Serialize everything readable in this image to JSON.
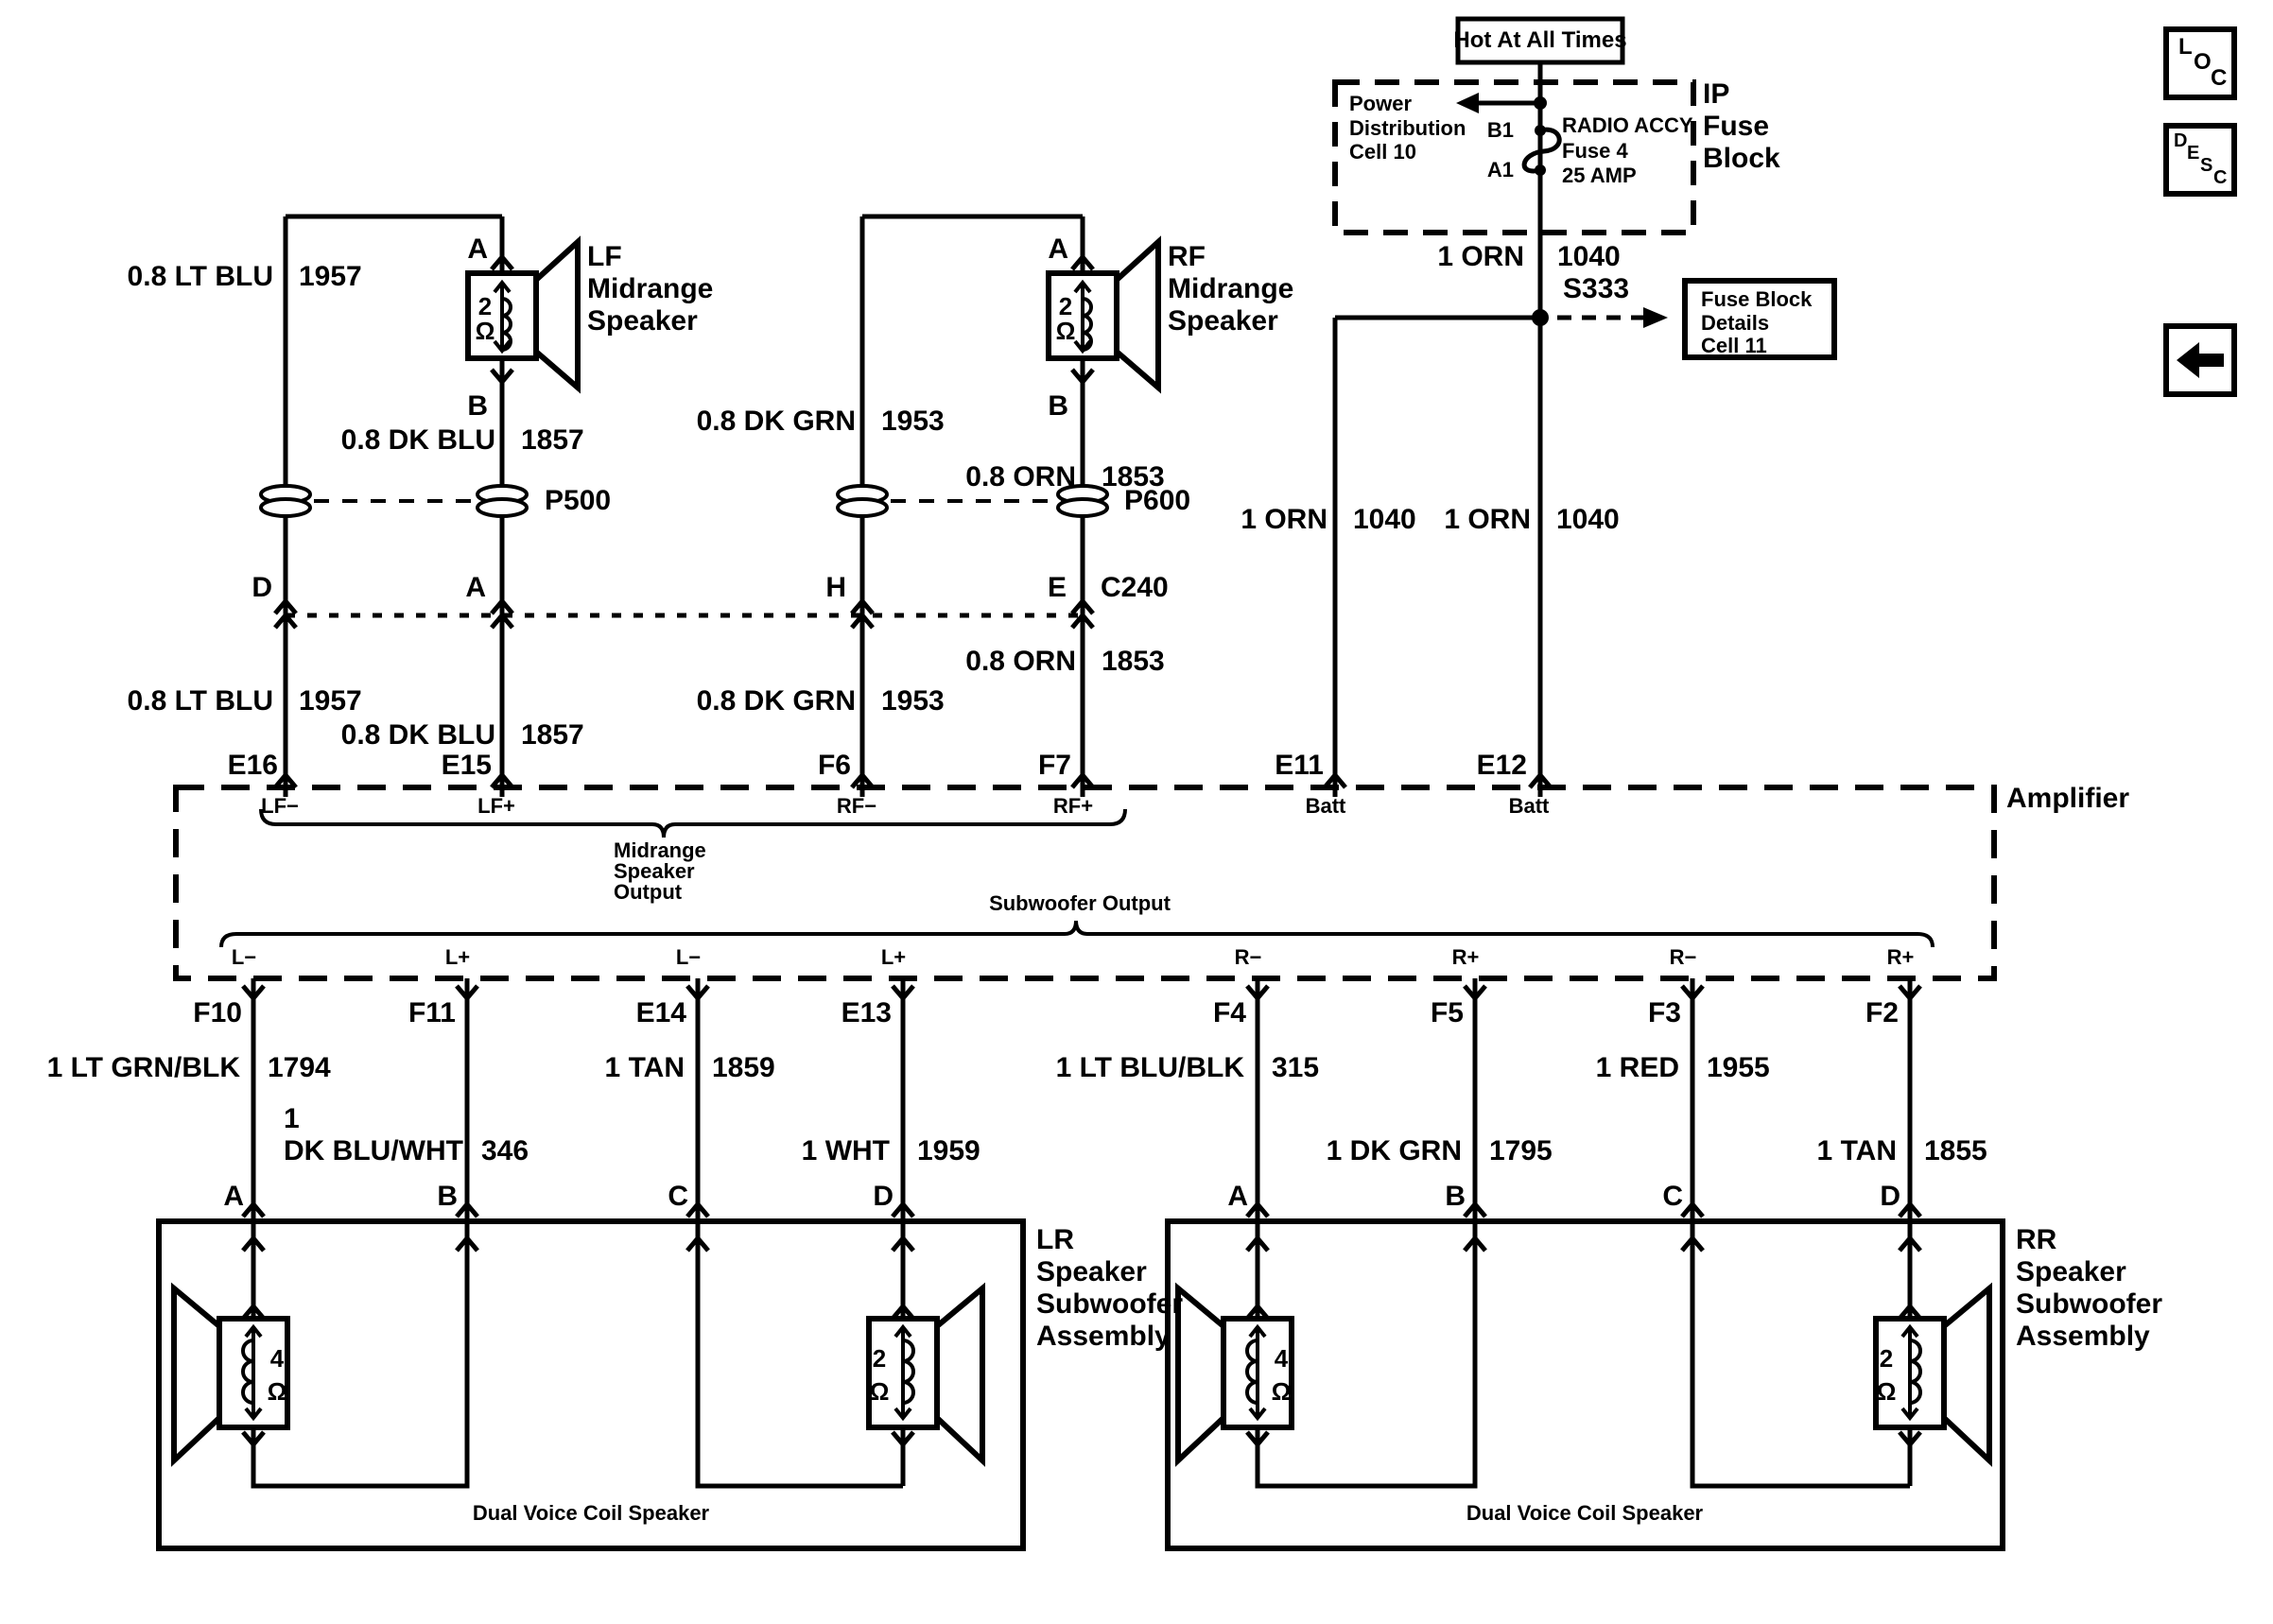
{
  "controls": {
    "loc": {
      "letters": [
        "L",
        "O",
        "C"
      ]
    },
    "desc": {
      "letters": [
        "D",
        "E",
        "S",
        "C"
      ]
    }
  },
  "power": {
    "hot_label": "Hot At All Times",
    "block_label": [
      "IP",
      "Fuse",
      "Block"
    ],
    "power_dist": [
      "Power",
      "Distribution",
      "Cell 10"
    ],
    "terminal_b1": "B1",
    "terminal_a1": "A1",
    "fuse_info": [
      "RADIO ACCY",
      "Fuse 4",
      "25 AMP"
    ],
    "fuse_out_wire": {
      "name": "1 ORN",
      "circuit": "1040"
    },
    "splice": "S333",
    "details_ref": [
      "Fuse Block",
      "Details",
      "Cell 11"
    ]
  },
  "speakers": {
    "lf": {
      "lines": [
        "LF",
        "Midrange",
        "Speaker"
      ],
      "impedance": "2",
      "ohm": "Ω",
      "pin_top": "A",
      "pin_bottom": "B"
    },
    "rf": {
      "lines": [
        "RF",
        "Midrange",
        "Speaker"
      ],
      "impedance": "2",
      "ohm": "Ω",
      "pin_top": "A",
      "pin_bottom": "B"
    }
  },
  "connectors": {
    "p500": "P500",
    "p600": "P600",
    "c240_label": "C240",
    "c240_pins": [
      "D",
      "A",
      "H",
      "E"
    ]
  },
  "wires": {
    "lf_neg": {
      "name": "0.8 LT BLU",
      "circuit": "1957"
    },
    "lf_pos": {
      "name": "0.8 DK BLU",
      "circuit": "1857"
    },
    "rf_neg": {
      "name": "0.8 DK GRN",
      "circuit": "1953"
    },
    "rf_pos": {
      "name": "0.8 ORN",
      "circuit": "1853"
    },
    "batt_e11": {
      "name": "1 ORN",
      "circuit": "1040"
    },
    "batt_e12": {
      "name": "1 ORN",
      "circuit": "1040"
    },
    "f10": {
      "name": "1 LT GRN/BLK",
      "circuit": "1794"
    },
    "f11": {
      "prefix": "1",
      "name": "DK BLU/WHT",
      "circuit": "346"
    },
    "e14": {
      "name": "1 TAN",
      "circuit": "1859"
    },
    "e13": {
      "name": "1 WHT",
      "circuit": "1959"
    },
    "f4": {
      "name": "1 LT BLU/BLK",
      "circuit": "315"
    },
    "f5": {
      "name": "1 DK GRN",
      "circuit": "1795"
    },
    "f3": {
      "name": "1 RED",
      "circuit": "1955"
    },
    "f2": {
      "name": "1 TAN",
      "circuit": "1855"
    }
  },
  "amplifier": {
    "label": "Amplifier",
    "top_pins": [
      "E16",
      "E15",
      "F6",
      "F7",
      "E11",
      "E12"
    ],
    "top_functions": [
      "LF−",
      "LF+",
      "RF−",
      "RF+",
      "Batt",
      "Batt"
    ],
    "midrange_brace": [
      "Midrange",
      "Speaker",
      "Output"
    ],
    "subwoofer_brace": "Subwoofer Output",
    "bottom_functions": [
      "L−",
      "L+",
      "L−",
      "L+",
      "R−",
      "R+",
      "R−",
      "R+"
    ],
    "bottom_pins": [
      "F10",
      "F11",
      "E14",
      "E13",
      "F4",
      "F5",
      "F3",
      "F2"
    ]
  },
  "assemblies": {
    "lr": {
      "lines": [
        "LR",
        "Speaker",
        "Subwoofer",
        "Assembly"
      ],
      "pins": [
        "A",
        "B",
        "C",
        "D"
      ],
      "coil_left": "4",
      "coil_right": "2",
      "ohm": "Ω",
      "caption": "Dual Voice Coil Speaker"
    },
    "rr": {
      "lines": [
        "RR",
        "Speaker",
        "Subwoofer",
        "Assembly"
      ],
      "pins": [
        "A",
        "B",
        "C",
        "D"
      ],
      "coil_left": "4",
      "coil_right": "2",
      "ohm": "Ω",
      "caption": "Dual Voice Coil Speaker"
    }
  }
}
